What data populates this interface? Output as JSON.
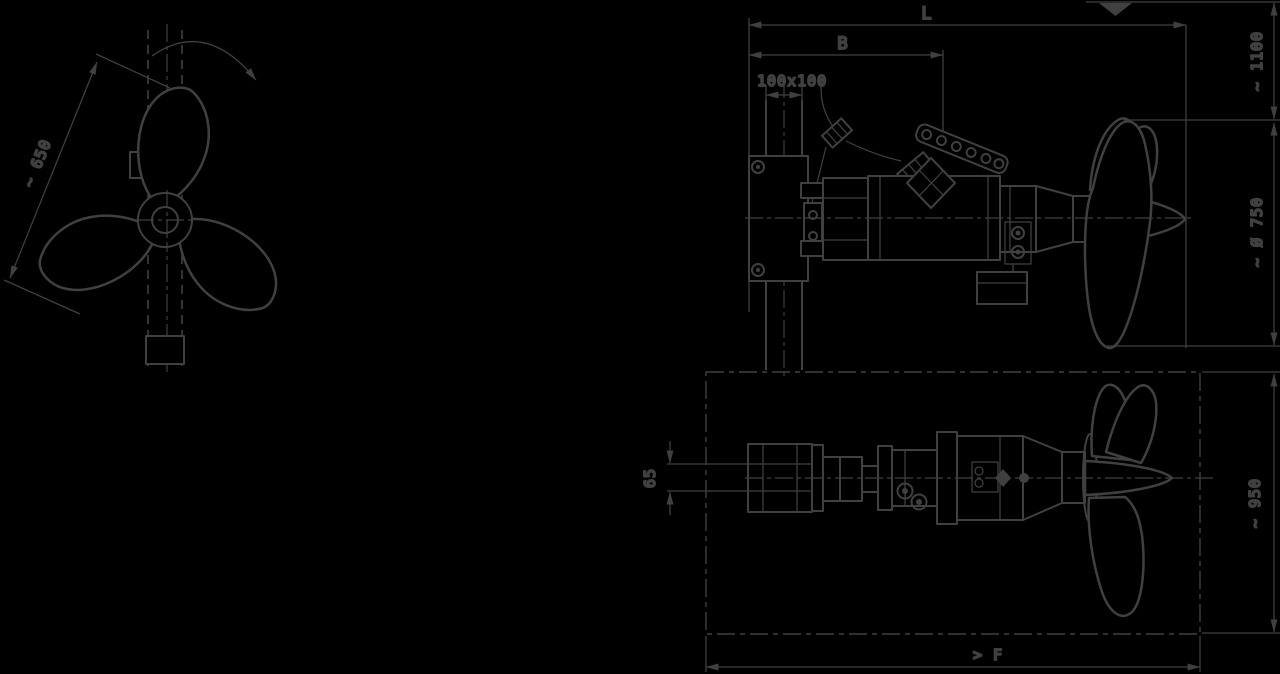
{
  "canvas": {
    "background": "#000000",
    "line_color": "#404040",
    "description": "Engineering dimension drawing of a submersible mixer with guide mast: propeller front view, installation side view and top (plan) view"
  },
  "views": {
    "front_view": {
      "title": "propeller-front-view",
      "dim_diameter": "~ 650"
    },
    "side_view": {
      "title": "mixer-side-view",
      "dim_length": "L",
      "dim_bracket": "B",
      "dim_mast_section": "100x100",
      "dim_min_submergence": "~ 1100",
      "dim_propeller_diameter": "~ Ø 750"
    },
    "top_view": {
      "title": "mixer-top-view",
      "dim_guide_rail": "65",
      "dim_clearance_width": "~ 950",
      "dim_floor_clearance": "> F"
    }
  }
}
